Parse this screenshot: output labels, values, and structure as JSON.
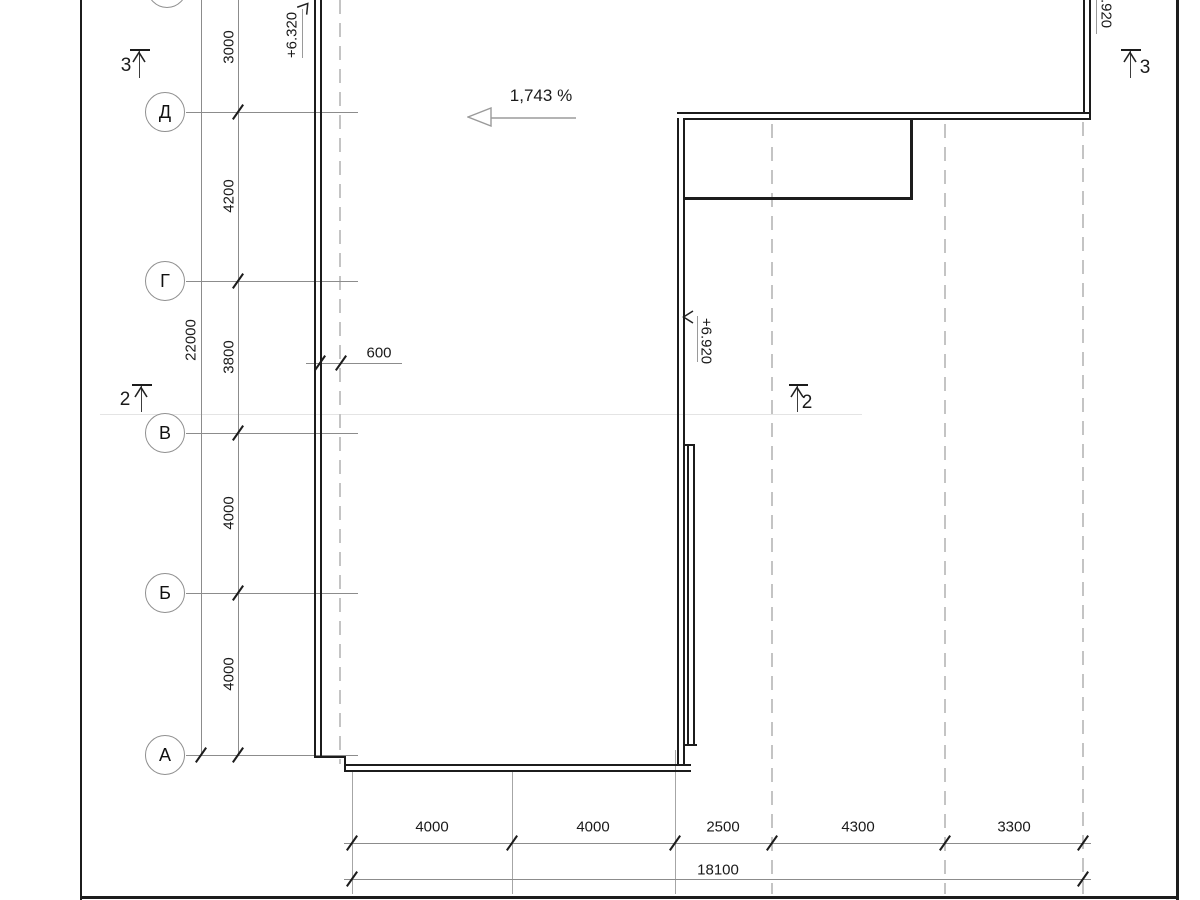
{
  "axes": {
    "labels": [
      "Д",
      "Г",
      "В",
      "Б",
      "А"
    ]
  },
  "dimensions": {
    "left_column": [
      "3000",
      "4200",
      "3800",
      "4000",
      "4000"
    ],
    "left_total": "22000",
    "wall_offset": "600",
    "bottom_row": [
      "4000",
      "4000",
      "2500",
      "4300",
      "3300"
    ],
    "bottom_total": "18100"
  },
  "annotations": {
    "slope": "1,743 %",
    "elevation_left": "+6.320",
    "elevation_mid": "+6.920",
    "elevation_top_right": "+6.920",
    "section_mark_3": "3",
    "section_mark_2": "2"
  },
  "colors": {
    "building_line": "#1c1c1c",
    "dim_line": "#8c8c8c",
    "dashed_grid": "#c4c4c4"
  }
}
